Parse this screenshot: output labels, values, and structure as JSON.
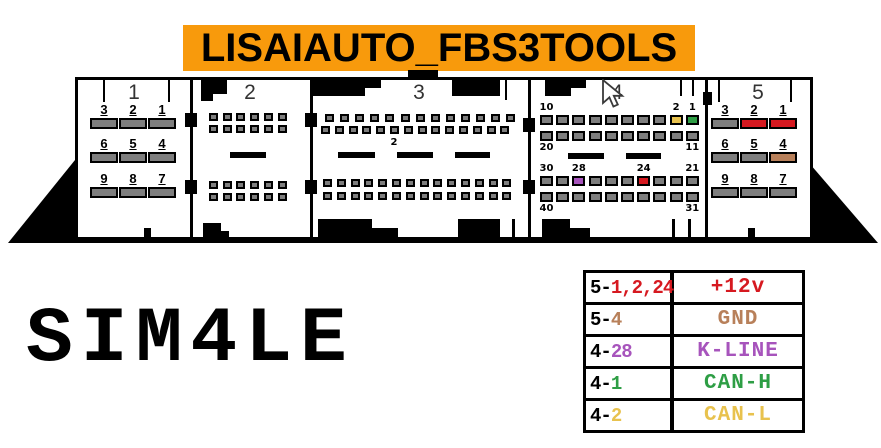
{
  "banner": {
    "text": "LISAIAUTO_FBS3TOOLS"
  },
  "model_label": "SIM4LE",
  "icons": {
    "cursor": "mouse-arrow-pointer"
  },
  "palette": {
    "banner_orange": "#F89A0C",
    "pin_gray": "#7E7E7E",
    "red": "#D61920",
    "tan": "#B8805A",
    "yellow": "#E8C24E",
    "green": "#2E9E45",
    "purple": "#A754BC"
  },
  "connector": {
    "sections": [
      {
        "header": "1",
        "type": "big9",
        "pin_rows": [
          [
            "3",
            "2",
            "1"
          ],
          [
            "6",
            "5",
            "4"
          ],
          [
            "9",
            "8",
            "7"
          ]
        ],
        "pin_colors": {}
      },
      {
        "header": "2",
        "type": "grid",
        "rows": [
          {
            "count": 6
          },
          {
            "count": 6
          },
          {
            "count": 6
          },
          {
            "count": 6
          }
        ]
      },
      {
        "header": "3",
        "type": "grid",
        "note": "2",
        "rows": [
          {
            "count": 13
          },
          {
            "count": 14
          },
          {
            "count": 14
          },
          {
            "count": 14
          }
        ]
      },
      {
        "header": "4",
        "type": "grid",
        "rows": [
          {
            "count": 10,
            "label_side": "top",
            "labels": {
              "0": "10",
              "8": "2",
              "9": "1"
            },
            "pin_colors": {
              "8": "yellow",
              "9": "green"
            }
          },
          {
            "count": 10,
            "label_side": "bottom",
            "labels": {
              "0": "20",
              "9": "11"
            }
          },
          {
            "count": 10,
            "label_side": "top",
            "labels": {
              "0": "30",
              "2": "28",
              "6": "24",
              "9": "21"
            },
            "pin_colors": {
              "2": "purple",
              "6": "red"
            }
          },
          {
            "count": 10,
            "label_side": "bottom",
            "labels": {
              "0": "40",
              "9": "31"
            }
          }
        ]
      },
      {
        "header": "5",
        "type": "big9",
        "pin_rows": [
          [
            "3",
            "2",
            "1"
          ],
          [
            "6",
            "5",
            "4"
          ],
          [
            "9",
            "8",
            "7"
          ]
        ],
        "pin_colors": {
          "1": "red",
          "2": "red",
          "4": "tan"
        }
      }
    ]
  },
  "table": {
    "rows": [
      {
        "prefix": "5-",
        "pins": "1,2,24",
        "signal": "+12v",
        "color": "red"
      },
      {
        "prefix": "5-",
        "pins": "4",
        "signal": "GND",
        "color": "tan"
      },
      {
        "prefix": "4-",
        "pins": "28",
        "signal": "K-LINE",
        "color": "purple"
      },
      {
        "prefix": "4-",
        "pins": "1",
        "signal": "CAN-H",
        "color": "green"
      },
      {
        "prefix": "4-",
        "pins": "2",
        "signal": "CAN-L",
        "color": "yellow"
      }
    ]
  }
}
